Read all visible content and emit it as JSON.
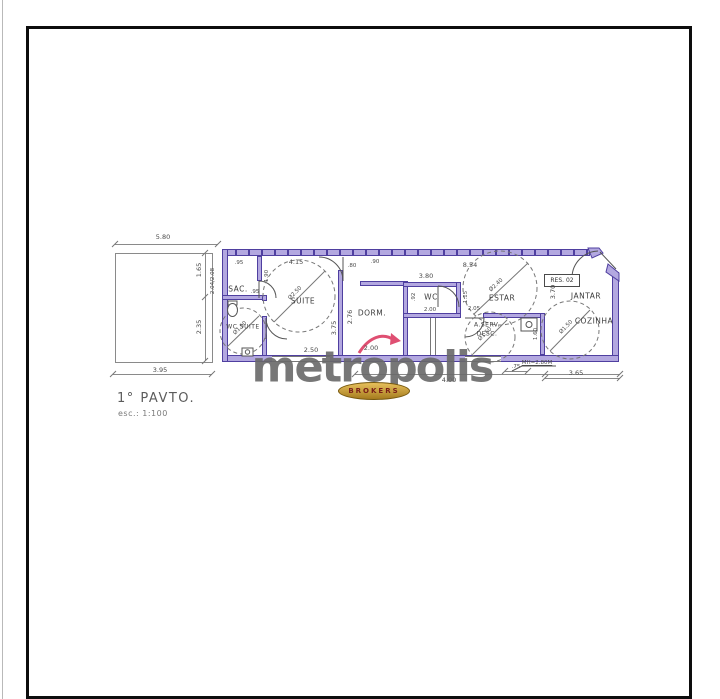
{
  "plan": {
    "title": "1° PAVTO.",
    "scale": "esc.: 1:100",
    "unit_tag": "RES. 02",
    "ceiling_note": "MH=2.80M"
  },
  "watermark": {
    "brand": "metropolis",
    "badge": "BROKERS"
  },
  "colors": {
    "wall_fill": "#b3a8e0",
    "wall_line": "#4f3fa0",
    "brand_gray": "#686868",
    "badge_gold": "#c79a3b",
    "arrow_red": "#df4f72"
  },
  "rooms": {
    "sac": "SAC.",
    "wc_suite": "WC SUITE",
    "suite": "SUITE",
    "dorm": "DORM.",
    "wc": "WC",
    "estar": "ESTAR",
    "aserv1": "A.SERV.",
    "aserv2": "DESC.",
    "jantar": "JANTAR",
    "cozinha": "COZINHA"
  },
  "dims": {
    "top_width": "5.80",
    "left_upper": "1.65",
    "left_lower": "2.35",
    "left_inner": "2.04/2.08",
    "bottom_left": "3.95",
    "sac_w": ".95",
    "sac_d": "1.90",
    "suite_entry": ".95",
    "suite_w": "4.15",
    "suite_d": "3.75",
    "suite_b": "2.50",
    "hall_a": ".80",
    "hall_b": ".90",
    "dorm_d": "2.76",
    "dorm_w": "2.00",
    "wc_top": "3.80",
    "wc_left": ".92",
    "wc_w": "2.00",
    "wc_right": "1.15",
    "estar_top": "8.54",
    "estar_b": "2.05",
    "aserv_r": "1.60",
    "jantar_d": "3.70",
    "bottom_mid": "4.00",
    "bottom_step": ".75",
    "bottom_right": "3.65",
    "circ_suite": "Ø2.50",
    "circ_estar": "Ø2.40",
    "circ_aserv": "Ø1.50",
    "circ_coz": "Ø1.50",
    "circ_wcs": "Ø1.50"
  }
}
